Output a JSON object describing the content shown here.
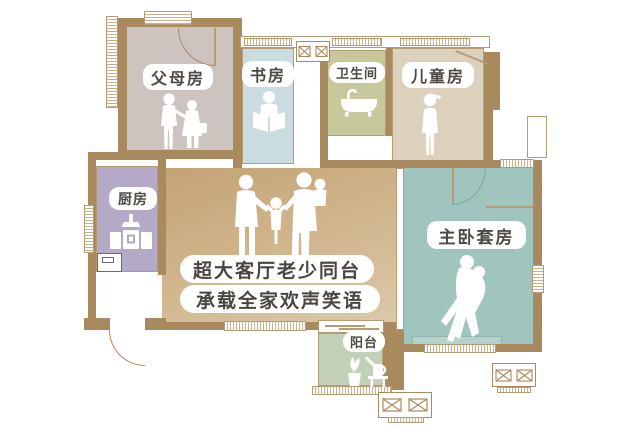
{
  "rooms": {
    "parents": {
      "label": "父母房"
    },
    "study": {
      "label": "书房"
    },
    "bathroom": {
      "label": "卫生间"
    },
    "kids": {
      "label": "儿童房"
    },
    "kitchen": {
      "label": "厨房"
    },
    "master": {
      "label": "主卧套房"
    },
    "balcony": {
      "label": "阳台"
    }
  },
  "living_room": {
    "slogan_line1": "超大客厅老少同台",
    "slogan_line2": "承载全家欢声笑语"
  },
  "icons": {
    "parents": "elderly-couple-icon",
    "study": "person-reading-icon",
    "bathroom": "bathtub-icon",
    "kids": "child-icon",
    "kitchen": "stove-faucet-icon",
    "living": "family-of-four-icon",
    "master": "embracing-couple-icon",
    "balcony": "plant-watering-can-icon",
    "ac": "ac-outdoor-unit-icon"
  },
  "colors": {
    "wall": "#a9895e",
    "outline": "#b79b73",
    "label_text": "#4f4a43",
    "parents_fill": "#cdc4c0",
    "study_fill": "#cbdce1",
    "bathroom_fill": "#c7c99c",
    "kids_fill": "#dbd1bc",
    "kitchen_fill": "#b5a9c8",
    "living_gradient_start": "#c3a376",
    "living_gradient_end": "#dcc9ab",
    "master_fill": "#a0c5bf",
    "balcony_fill": "#c1d0b7"
  }
}
